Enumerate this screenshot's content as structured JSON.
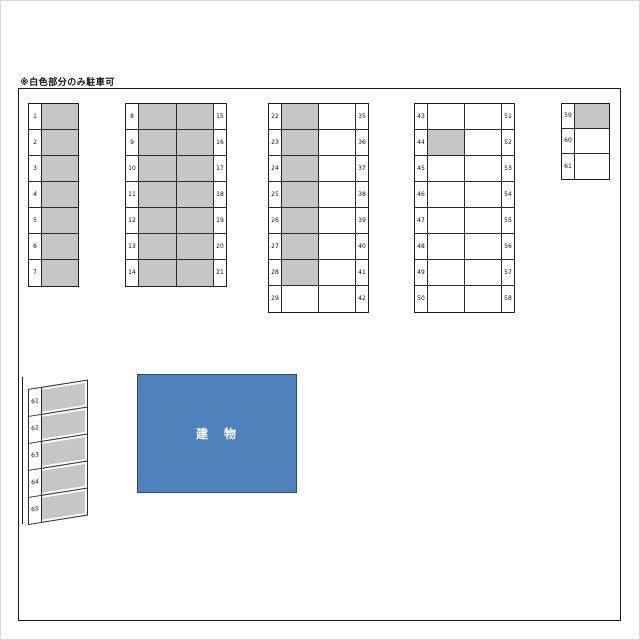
{
  "note": "※白色部分のみ駐車可",
  "building": {
    "label": "建　物"
  },
  "colors": {
    "unavailable_fill": "#c6c6c6",
    "available_fill": "#ffffff",
    "line": "#1a1a1a",
    "building_fill": "#4f81bd",
    "building_border": "#2c4d6e"
  },
  "blocks": {
    "a": {
      "rows": [
        {
          "l": "1",
          "c": [
            1
          ]
        },
        {
          "l": "2",
          "c": [
            1
          ]
        },
        {
          "l": "3",
          "c": [
            1
          ]
        },
        {
          "l": "4",
          "c": [
            1
          ]
        },
        {
          "l": "5",
          "c": [
            1
          ]
        },
        {
          "l": "6",
          "c": [
            1
          ]
        },
        {
          "l": "7",
          "c": [
            1
          ]
        }
      ]
    },
    "b": {
      "rows": [
        {
          "l": "8",
          "c": [
            1,
            1
          ],
          "r": "15"
        },
        {
          "l": "9",
          "c": [
            1,
            1
          ],
          "r": "16"
        },
        {
          "l": "10",
          "c": [
            1,
            1
          ],
          "r": "17"
        },
        {
          "l": "11",
          "c": [
            1,
            1
          ],
          "r": "18"
        },
        {
          "l": "12",
          "c": [
            1,
            1
          ],
          "r": "19"
        },
        {
          "l": "13",
          "c": [
            1,
            1
          ],
          "r": "20"
        },
        {
          "l": "14",
          "c": [
            1,
            1
          ],
          "r": "21"
        }
      ]
    },
    "c": {
      "rows": [
        {
          "l": "22",
          "c": [
            1,
            0
          ],
          "r": "35"
        },
        {
          "l": "23",
          "c": [
            1,
            0
          ],
          "r": "36"
        },
        {
          "l": "24",
          "c": [
            1,
            0
          ],
          "r": "37"
        },
        {
          "l": "25",
          "c": [
            1,
            0
          ],
          "r": "38"
        },
        {
          "l": "26",
          "c": [
            1,
            0
          ],
          "r": "39"
        },
        {
          "l": "27",
          "c": [
            1,
            0
          ],
          "r": "40"
        },
        {
          "l": "28",
          "c": [
            1,
            0
          ],
          "r": "41"
        },
        {
          "l": "29",
          "c": [
            0,
            0
          ],
          "r": "42"
        }
      ]
    },
    "d": {
      "rows": [
        {
          "l": "43",
          "c": [
            0,
            0
          ],
          "r": "51"
        },
        {
          "l": "44",
          "c": [
            1,
            0
          ],
          "r": "52"
        },
        {
          "l": "45",
          "c": [
            0,
            0
          ],
          "r": "53"
        },
        {
          "l": "46",
          "c": [
            0,
            0
          ],
          "r": "54"
        },
        {
          "l": "47",
          "c": [
            0,
            0
          ],
          "r": "55"
        },
        {
          "l": "48",
          "c": [
            0,
            0
          ],
          "r": "56"
        },
        {
          "l": "49",
          "c": [
            0,
            0
          ],
          "r": "57"
        },
        {
          "l": "50",
          "c": [
            0,
            0
          ],
          "r": "58"
        }
      ]
    },
    "e": {
      "rows": [
        {
          "l": "59",
          "c": [
            1
          ]
        },
        {
          "l": "60",
          "c": [
            0
          ]
        },
        {
          "l": "61",
          "c": [
            0
          ]
        }
      ]
    },
    "f": {
      "rows": [
        {
          "l": "61",
          "c": [
            1
          ]
        },
        {
          "l": "62",
          "c": [
            1
          ]
        },
        {
          "l": "63",
          "c": [
            1
          ]
        },
        {
          "l": "64",
          "c": [
            1
          ]
        },
        {
          "l": "65",
          "c": [
            1
          ]
        }
      ]
    }
  }
}
